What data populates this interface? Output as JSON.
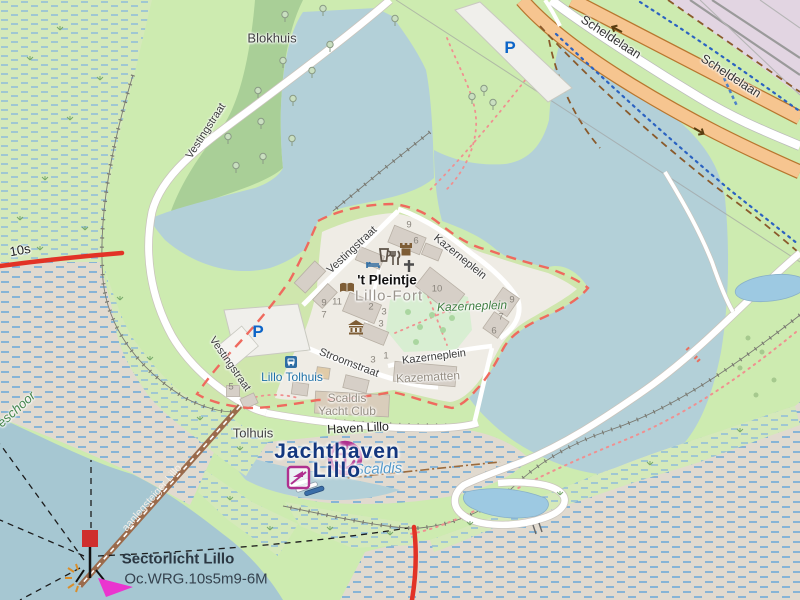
{
  "labels": {
    "blokhuis": "Blokhuis",
    "vestingstraat": "Vestingstraat",
    "scheldelaan": "Scheldelaan",
    "kazerneplein": "Kazerneplein",
    "kazematten": "Kazematten",
    "stroomstraat": "Stroomstraat",
    "pleintje": "'t Pleintje",
    "lillo_fort": "Lillo-Fort",
    "lillo_tolhuis": "Lillo Tolhuis",
    "tolhuis": "Tolhuis",
    "scaldis_line1": "Scaldis",
    "scaldis_line2": "Yacht Club",
    "haven_lillo": "Haven Lillo",
    "jachthaven_line1": "Jachthaven",
    "jachthaven_line2": "Lillo",
    "scaldis_water": "Scaldis",
    "sectorlicht": "Sectorlicht Lillo",
    "light_character": "Oc.WRG.10s5m9-6M",
    "sector_10s": "10s",
    "schoor": "eschoor",
    "steiger": "aanlegsteiger Lillo",
    "parking": "P"
  },
  "house_numbers": [
    "9",
    "6",
    "10",
    "9",
    "7",
    "6",
    "9",
    "11",
    "7",
    "2",
    "3",
    "3",
    "3",
    "1",
    "5"
  ],
  "icons": [
    "parking-icon",
    "bus-stop-icon",
    "pub-icon",
    "restaurant-icon",
    "castle-icon",
    "cross-icon",
    "hotel-bed-icon",
    "library-book-icon",
    "museum-icon",
    "harbour-anchor-icon",
    "slipway-icon",
    "sector-light-beacon-icon"
  ],
  "colors": {
    "water": "#b3d0d8",
    "pond": "#9dc9e2",
    "grass": "#cdebb0",
    "forest": "#a9cf97",
    "marsh": "#d5e9ba",
    "tidal_flat": "#e1dacf",
    "industrial": "#e2d5e2",
    "trunk_road": "#f6c590",
    "boundary_red": "#ef6a5e",
    "seamark_magenta": "#b0308f",
    "harbour_label_navy": "#14377e",
    "sector_line_red": "#e23326",
    "transport_blue": "#2e6da4",
    "footpath_red": "#f09090"
  }
}
